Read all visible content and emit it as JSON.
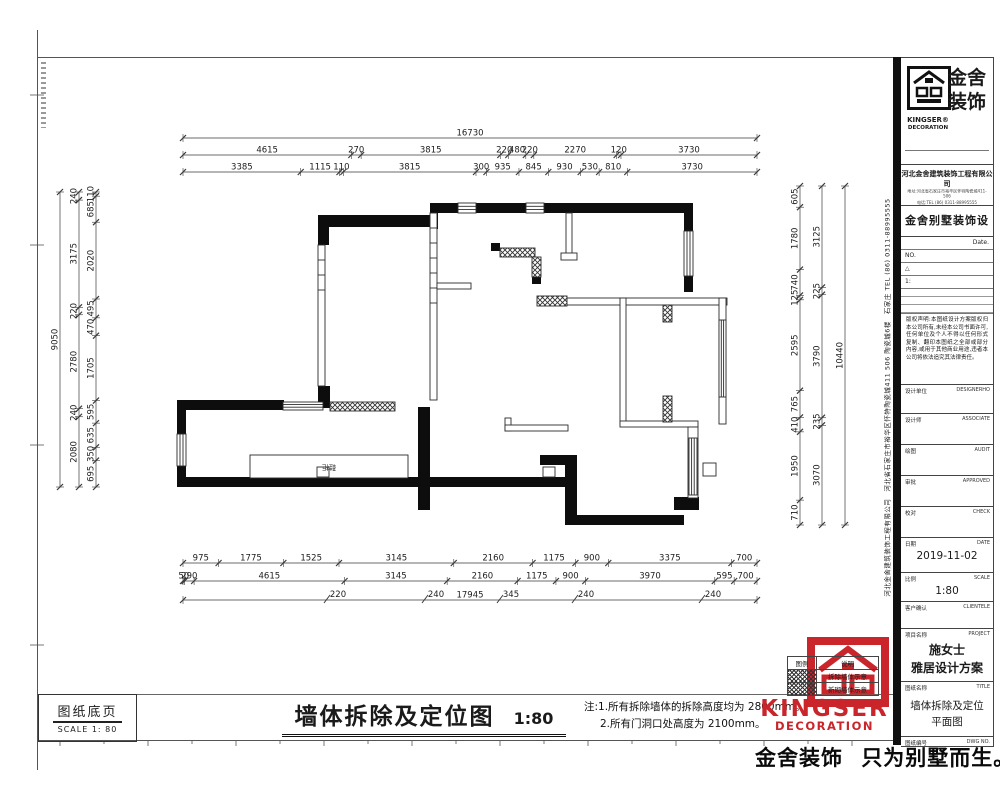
{
  "titlebar": {
    "main_title": "墙体拆除及定位图",
    "main_scale": "1:80",
    "note_line1": "注:1.所有拆除墙体的拆除高度均为 2800mm。",
    "note_line2": "2.所有门洞口处高度为 2100mm。",
    "corner_line1": "图纸底页",
    "corner_line2": "SCALE 1: 80"
  },
  "slogan": {
    "part1": "金舍装饰",
    "part2": "只为别墅而生。"
  },
  "legend": {
    "col1": "图例",
    "col2": "说明",
    "rows": [
      {
        "label": "拆除墙体示意"
      },
      {
        "label": "新砌墙体示意"
      }
    ]
  },
  "red_logo": {
    "line1": "KINGSER",
    "line2": "DECORATION"
  },
  "title_block": {
    "brand_cn_1": "金舍",
    "brand_cn_2": "装饰",
    "brand_en_1": "KINGSER®",
    "brand_en_2": "DECORATION",
    "company": "河北金舍建筑装饰工程有限公司",
    "addr1": "地址:河北省石家庄市裕华区怀特陶瓷城411-506",
    "addr2": "电话:TEL (86) 0311-88995555",
    "product": "金舍别墅装饰设计",
    "date_small": "Date.",
    "no": "NO.",
    "tri": "△",
    "one": "1:",
    "disclaimer": "版权声明:本图纸设计方案版权归本公司所有,未经本公司书面许可,任何单位及个人不得以任何形式复制、翻印本图纸之全部或部分内容,或用于其他商业用途,违者本公司将依法追究其法律责任。",
    "rows": [
      {
        "cn": "设计单位",
        "en": "DESIGNERHO",
        "value": "",
        "value2": ""
      },
      {
        "cn": "设计师",
        "en": "ASSOCIATE",
        "value": "",
        "value2": ""
      },
      {
        "cn": "绘图",
        "en": "AUDIT",
        "value": "",
        "value2": ""
      },
      {
        "cn": "审批",
        "en": "APPROVED",
        "value": "",
        "value2": ""
      },
      {
        "cn": "校对",
        "en": "CHECK",
        "value": "",
        "value2": ""
      },
      {
        "cn": "日期",
        "en": "DATE",
        "value": "2019-11-02",
        "value2": ""
      },
      {
        "cn": "比例",
        "en": "SCALE",
        "value": "1:80",
        "value2": ""
      },
      {
        "cn": "客户确认",
        "en": "CLIENTELE",
        "value": "",
        "value2": ""
      },
      {
        "cn": "项目名称",
        "en": "PROJECT",
        "value": "施女士",
        "value2": "雅居设计方案"
      },
      {
        "cn": "图纸名称",
        "en": "TITLE",
        "value": "墙体拆除及定位",
        "value2": "平面图"
      },
      {
        "cn": "图纸编号",
        "en": "DWG NO.",
        "value": "",
        "value2": ""
      }
    ],
    "vertical_text": "河北金舍建筑装饰工程有限公司　河北省石家庄市裕华区怀特陶瓷城411 506 陶瓷城6楼　石家庄 TEL (86) 0311-88995555"
  },
  "plan": {
    "cabinet_label": "鞋柜"
  },
  "dimensions": {
    "top": {
      "x0": 183,
      "x1": 757,
      "rows": [
        {
          "y": 138,
          "values": [
            16730
          ]
        },
        {
          "y": 155,
          "values": [
            4615,
            270,
            3815,
            220,
            480,
            220,
            2270,
            120,
            3730
          ]
        },
        {
          "y": 172,
          "values": [
            3385,
            1115,
            110,
            3815,
            300,
            935,
            845,
            930,
            530,
            810,
            3730
          ]
        }
      ]
    },
    "bottom": {
      "x0": 183,
      "x1": 757,
      "rows": [
        {
          "y": 563,
          "values": [
            975,
            1775,
            1525,
            3145,
            2160,
            1175,
            900,
            3375,
            700
          ]
        },
        {
          "y": 581,
          "values": [
            50,
            290,
            4615,
            3145,
            2160,
            1175,
            900,
            3970,
            595,
            700
          ]
        },
        {
          "y": 600,
          "values": [
            17945
          ]
        }
      ]
    },
    "left": {
      "y0": 192,
      "y1": 487,
      "cols": [
        {
          "x": 60,
          "values": [
            9050
          ]
        },
        {
          "x": 79,
          "values": [
            240,
            3175,
            220,
            2780,
            240,
            2080
          ]
        },
        {
          "x": 96,
          "values": [
            110,
            685,
            2020,
            495,
            470,
            1705,
            595,
            635,
            350,
            695
          ]
        }
      ]
    },
    "right": {
      "y0": 186,
      "y1": 525,
      "cols": [
        {
          "x": 845,
          "values": [
            10440
          ]
        },
        {
          "x": 822,
          "values": [
            3125,
            225,
            3790,
            235,
            3070
          ]
        },
        {
          "x": 800,
          "values": [
            605,
            1780,
            740,
            125,
            2595,
            765,
            410,
            1950,
            710
          ]
        }
      ]
    },
    "floats": [
      {
        "x": 332,
        "y": 597,
        "v": 220
      },
      {
        "x": 430,
        "y": 597,
        "v": 240
      },
      {
        "x": 505,
        "y": 597,
        "v": 345
      },
      {
        "x": 580,
        "y": 597,
        "v": 240
      },
      {
        "x": 707,
        "y": 597,
        "v": 240
      }
    ]
  }
}
